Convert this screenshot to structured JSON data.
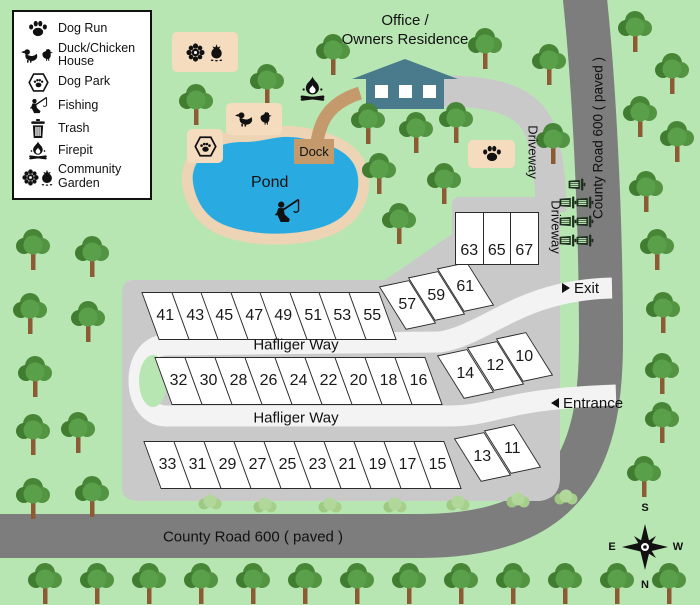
{
  "legend": {
    "items": [
      {
        "icon": "paw-icon",
        "label": "Dog Run"
      },
      {
        "icon": "duck-chicken-icon",
        "label": "Duck/Chicken House"
      },
      {
        "icon": "dog-park-icon",
        "label": "Dog Park"
      },
      {
        "icon": "fishing-icon",
        "label": "Fishing"
      },
      {
        "icon": "trash-icon",
        "label": "Trash"
      },
      {
        "icon": "firepit-icon",
        "label": "Firepit"
      },
      {
        "icon": "community-garden-icon",
        "label": "Community Garden"
      }
    ]
  },
  "office": {
    "line1": "Office /",
    "line2": "Owners Residence"
  },
  "pond": {
    "label": "Pond",
    "dock_label": "Dock"
  },
  "roads": {
    "hafliger_way": "Hafliger Way",
    "county_road": "County Road 600 ( paved )",
    "driveway": "Driveway",
    "exit_label": "Exit",
    "entrance_label": "Entrance"
  },
  "lots": {
    "row_top": [
      "41",
      "43",
      "45",
      "47",
      "49",
      "51",
      "53",
      "55"
    ],
    "row_top_diag": [
      "57",
      "59",
      "61"
    ],
    "driveway_block": [
      "63",
      "65",
      "67"
    ],
    "row_middle": [
      "32",
      "30",
      "28",
      "26",
      "24",
      "22",
      "20",
      "18",
      "16"
    ],
    "row_middle_diag": [
      "14",
      "12",
      "10"
    ],
    "row_bottom": [
      "33",
      "31",
      "29",
      "27",
      "25",
      "23",
      "21",
      "19",
      "17",
      "15"
    ],
    "row_bottom_diag": [
      "13",
      "11"
    ]
  },
  "compass": {
    "top": "S",
    "bottom": "N",
    "left": "E",
    "right": "W"
  },
  "colors": {
    "background": "#b8e6b2",
    "county_road": "#7d7d7d",
    "internal_road": "#f3f3f3",
    "pad": "#c9c9c9",
    "pond_water": "#29abe2",
    "pond_sand": "#ecd4b4",
    "facility": "#f5dcbf",
    "building": "#4a7b8c",
    "dock_path": "#c49a6c",
    "tree_green": "#4e8f3d"
  }
}
